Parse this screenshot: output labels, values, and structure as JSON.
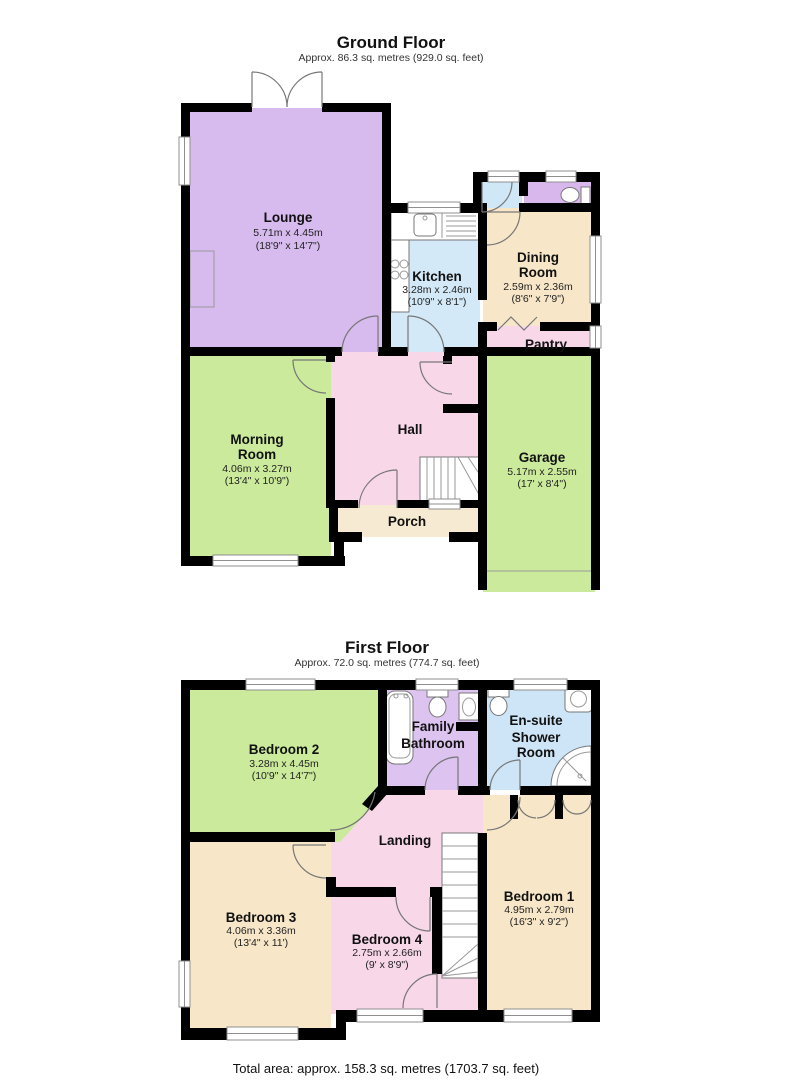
{
  "floors": [
    {
      "title": "Ground Floor",
      "subtitle": "Approx. 86.3 sq. metres (929.0 sq. feet)",
      "rooms": [
        {
          "id": "lounge",
          "name_lines": [
            "Lounge"
          ],
          "dim_m": "5.71m x 4.45m",
          "dim_ft": "(18'9\" x 14'7\")"
        },
        {
          "id": "kitchen",
          "name_lines": [
            "Kitchen"
          ],
          "dim_m": "3.28m x 2.46m",
          "dim_ft": "(10'9\" x 8'1\")"
        },
        {
          "id": "dining-room",
          "name_lines": [
            "Dining",
            "Room"
          ],
          "dim_m": "2.59m x 2.36m",
          "dim_ft": "(8'6\" x 7'9\")"
        },
        {
          "id": "pantry",
          "name_lines": [
            "Pantry"
          ],
          "dim_m": "",
          "dim_ft": ""
        },
        {
          "id": "morning-room",
          "name_lines": [
            "Morning",
            "Room"
          ],
          "dim_m": "4.06m x 3.27m",
          "dim_ft": "(13'4\" x 10'9\")"
        },
        {
          "id": "hall",
          "name_lines": [
            "Hall"
          ],
          "dim_m": "",
          "dim_ft": ""
        },
        {
          "id": "garage",
          "name_lines": [
            "Garage"
          ],
          "dim_m": "5.17m x 2.55m",
          "dim_ft": "(17' x 8'4\")"
        },
        {
          "id": "porch",
          "name_lines": [
            "Porch"
          ],
          "dim_m": "",
          "dim_ft": ""
        }
      ]
    },
    {
      "title": "First Floor",
      "subtitle": "Approx. 72.0 sq. metres (774.7 sq. feet)",
      "rooms": [
        {
          "id": "bedroom-2",
          "name_lines": [
            "Bedroom 2"
          ],
          "dim_m": "3.28m x 4.45m",
          "dim_ft": "(10'9\" x 14'7\")"
        },
        {
          "id": "family-bathroom",
          "name_lines": [
            "Family",
            "Bathroom"
          ],
          "dim_m": "",
          "dim_ft": ""
        },
        {
          "id": "en-suite-shower-room",
          "name_lines": [
            "En-suite",
            "Shower",
            "Room"
          ],
          "dim_m": "",
          "dim_ft": ""
        },
        {
          "id": "landing",
          "name_lines": [
            "Landing"
          ],
          "dim_m": "",
          "dim_ft": ""
        },
        {
          "id": "bedroom-1",
          "name_lines": [
            "Bedroom 1"
          ],
          "dim_m": "4.95m x 2.79m",
          "dim_ft": "(16'3\" x 9'2\")"
        },
        {
          "id": "bedroom-3",
          "name_lines": [
            "Bedroom 3"
          ],
          "dim_m": "4.06m x 3.36m",
          "dim_ft": "(13'4\" x 11')"
        },
        {
          "id": "bedroom-4",
          "name_lines": [
            "Bedroom 4"
          ],
          "dim_m": "2.75m x 2.66m",
          "dim_ft": "(9' x 8'9\")"
        }
      ]
    }
  ],
  "footer": "Total area: approx. 158.3 sq. metres (1703.7 sq. feet)",
  "colors": {
    "wall": "#000000",
    "lounge_purple": "#d7bbee",
    "room_green": "#cbea9b",
    "kitchen_blue": "#d3e9f8",
    "lobby_blue": "#cfe7f7",
    "ensuite_blue": "#cde5f6",
    "room_cream": "#f7e7c8",
    "porch_cream": "#f7ead2",
    "room_pink": "#f8d7e9",
    "bathroom_lilac": "#dcc3f0",
    "wc_lilac": "#d8b7ec"
  }
}
